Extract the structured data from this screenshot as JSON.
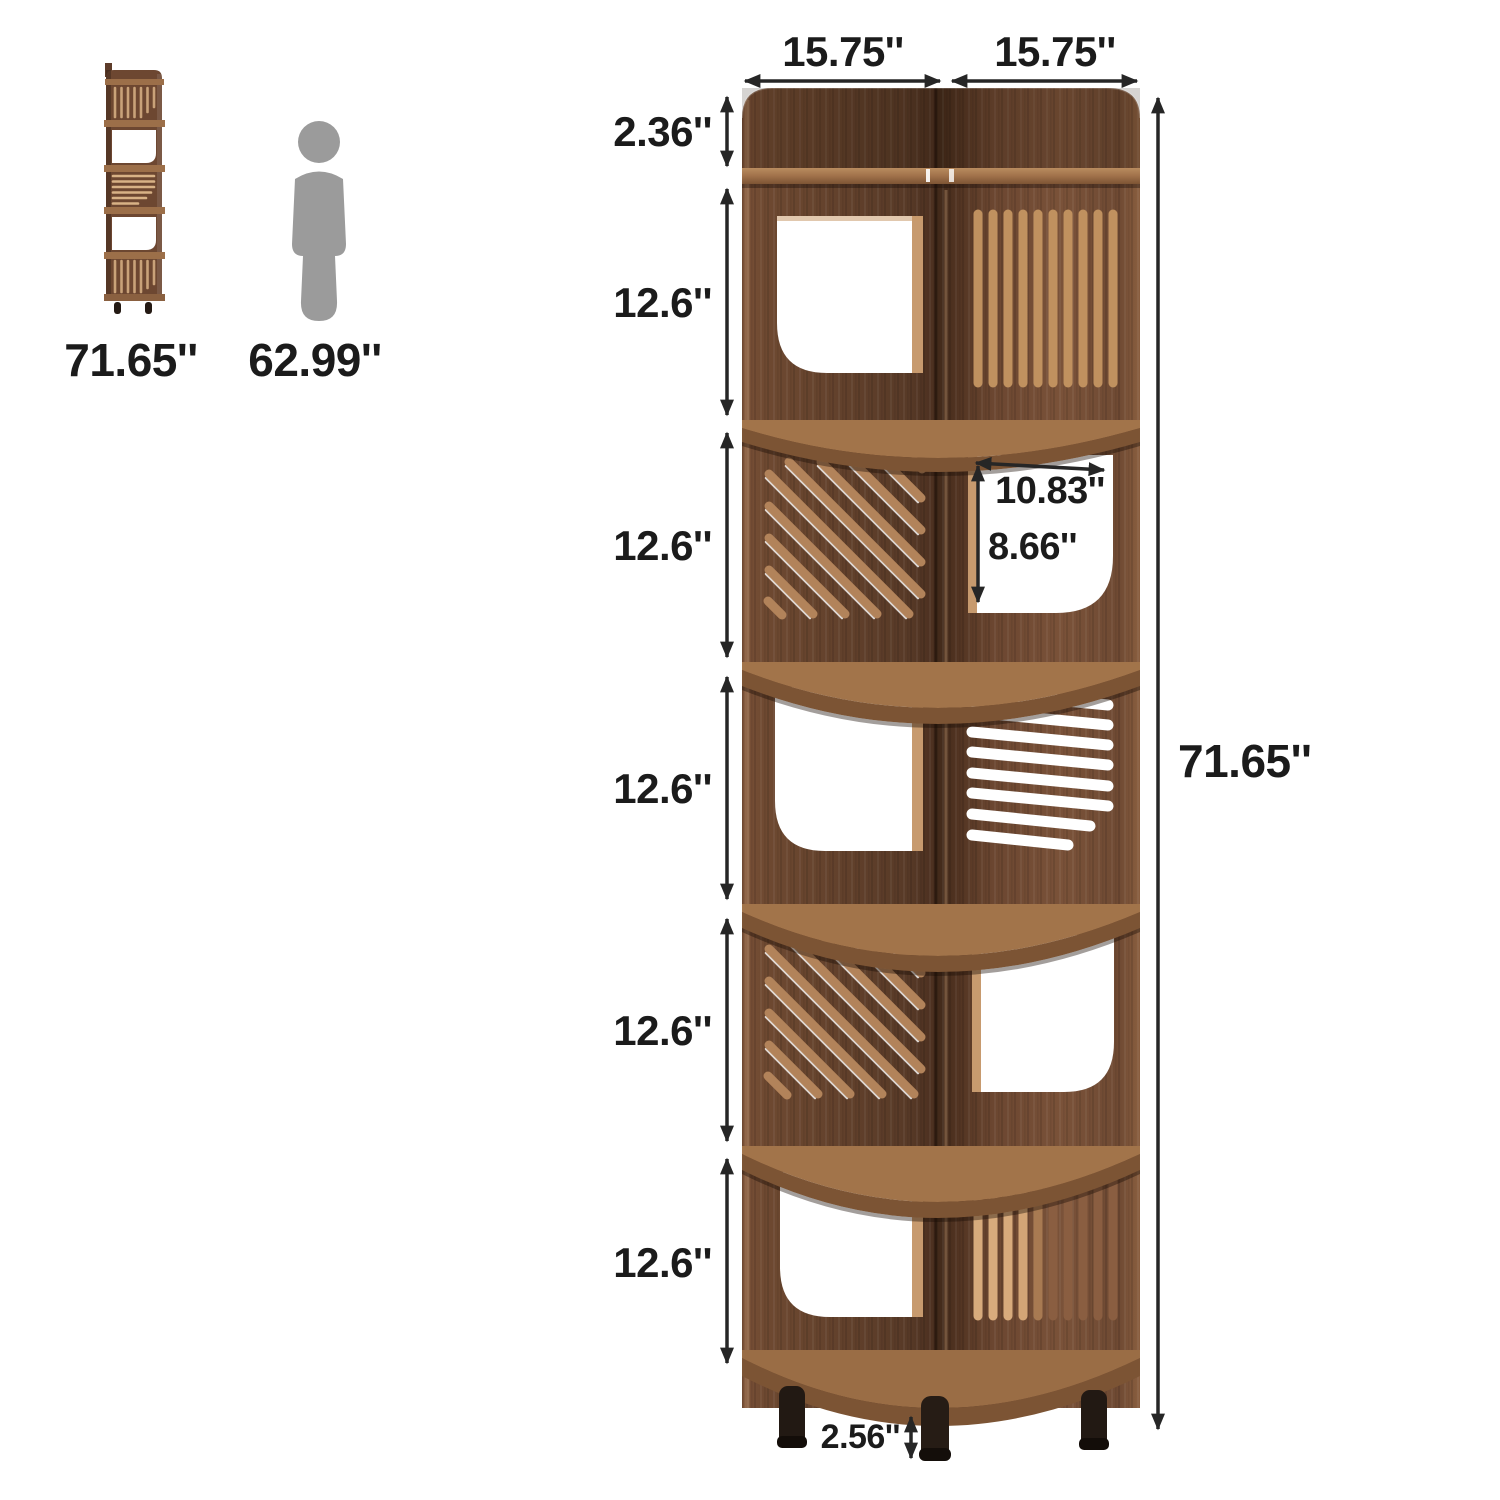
{
  "figure": {
    "title": "corner bookshelf dimension diagram"
  },
  "scale_reference": {
    "shelf_height_label": "71.65''",
    "person_height_label": "62.99''"
  },
  "dimensions": {
    "top_width_left": "15.75''",
    "top_width_right": "15.75''",
    "top_section_height": "2.36''",
    "shelf_section_heights": [
      "12.6''",
      "12.6''",
      "12.6''",
      "12.6''",
      "12.6''"
    ],
    "overall_height": "71.65''",
    "cutout_width": "10.83''",
    "cutout_height": "8.66''",
    "leg_height": "2.56''"
  },
  "colors": {
    "wood_dark": "#573826",
    "wood_mid": "#6f4a33",
    "wood_light_edge": "#a3744e",
    "board_surface": "#a1734a",
    "board_front": "#7d5434",
    "slat_light": "#c59367",
    "slat_bright": "#d8ab7c",
    "slat_engraved": "#5a3a28",
    "cutout_white": "#ffffff",
    "leg_dark": "#221913",
    "person_gray": "#9b9b9b",
    "dimension_line": "#262626",
    "label_text": "#1b1b1b"
  }
}
